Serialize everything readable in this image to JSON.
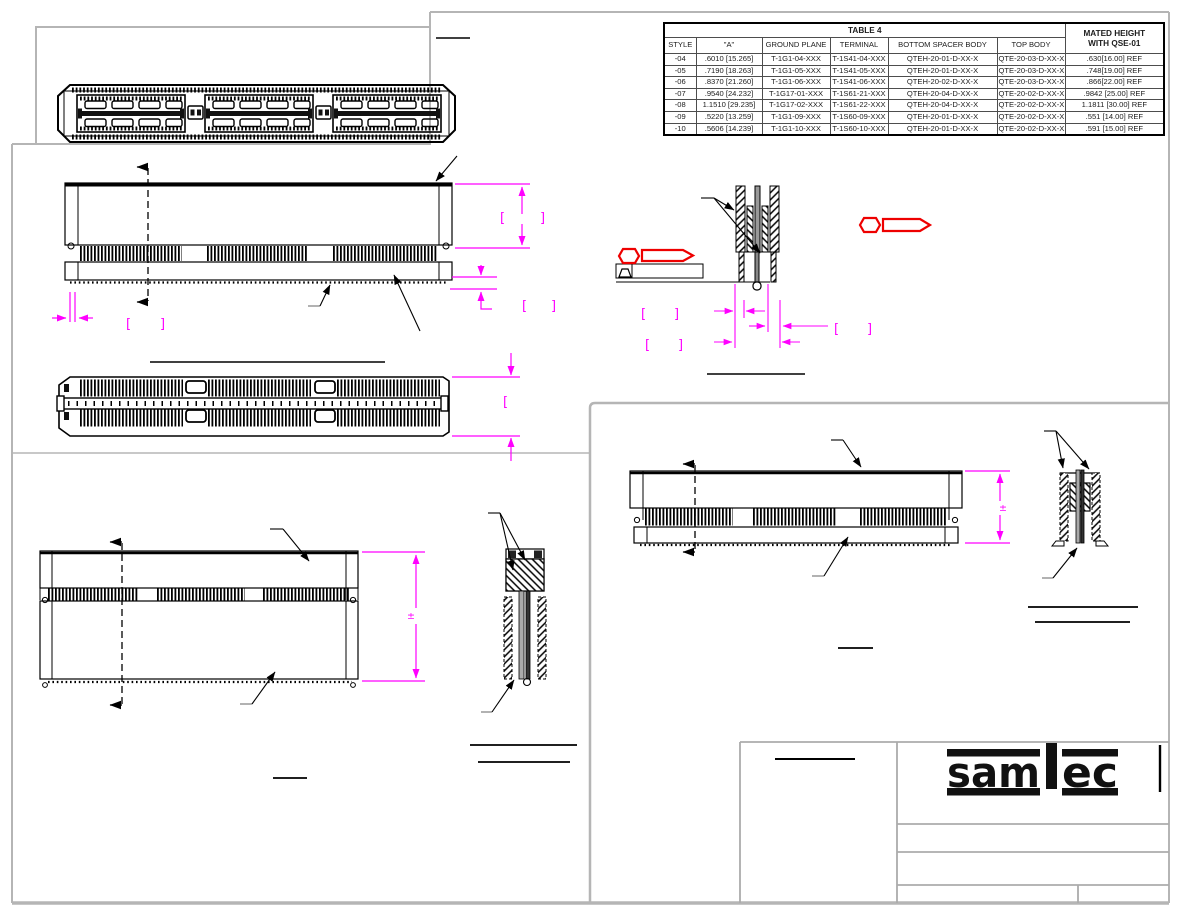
{
  "colors": {
    "dimension_magenta": "#ff00ff",
    "flag_red": "#ee0000",
    "frame_gray": "#b5b5b5",
    "line_black": "#000000"
  },
  "table4": {
    "title": "TABLE 4",
    "mated_header_line1": "MATED HEIGHT",
    "mated_header_line2": "WITH QSE-01",
    "columns": [
      "STYLE",
      "\"A\"",
      "GROUND PLANE",
      "TERMINAL",
      "BOTTOM SPACER BODY",
      "TOP BODY"
    ],
    "rows": [
      [
        "-04",
        ".6010 [15.265]",
        "T-1G1-04-XXX",
        "T-1S41-04-XXX",
        "QTEH-20-01-D-XX-X",
        "QTE-20-03-D-XX-X",
        ".630[16.00] REF"
      ],
      [
        "-05",
        ".7190 [18.263]",
        "T-1G1-05-XXX",
        "T-1S41-05-XXX",
        "QTEH-20-01-D-XX-X",
        "QTE-20-03-D-XX-X",
        ".748[19.00] REF"
      ],
      [
        "-06",
        ".8370 [21.260]",
        "T-1G1-06-XXX",
        "T-1S41-06-XXX",
        "QTEH-20-02-D-XX-X",
        "QTE-20-03-D-XX-X",
        ".866[22.00] REF"
      ],
      [
        "-07",
        ".9540 [24.232]",
        "T-1G17-01-XXX",
        "T-1S61-21-XXX",
        "QTEH-20-04-D-XX-X",
        "QTE-20-02-D-XX-X",
        ".9842 [25.00] REF"
      ],
      [
        "-08",
        "1.1510 [29.235]",
        "T-1G17-02-XXX",
        "T-1S61-22-XXX",
        "QTEH-20-04-D-XX-X",
        "QTE-20-02-D-XX-X",
        "1.1811 [30.00] REF"
      ],
      [
        "-09",
        ".5220 [13.259]",
        "T-1G1-09-XXX",
        "T-1S60-09-XXX",
        "QTEH-20-01-D-XX-X",
        "QTE-20-02-D-XX-X",
        ".551 [14.00] REF"
      ],
      [
        "-10",
        ".5606 [14.239]",
        "T-1G1-10-XXX",
        "T-1S60-10-XXX",
        "QTEH-20-01-D-XX-X",
        "QTE-20-02-D-XX-X",
        ".591 [15.00] REF"
      ]
    ]
  },
  "logo": {
    "brand": "samtec",
    "part_sam": "sam",
    "part_ec": "ec"
  },
  "annotations": {
    "bracket_open": "[",
    "bracket_close": "]",
    "plus_minus": "±"
  }
}
